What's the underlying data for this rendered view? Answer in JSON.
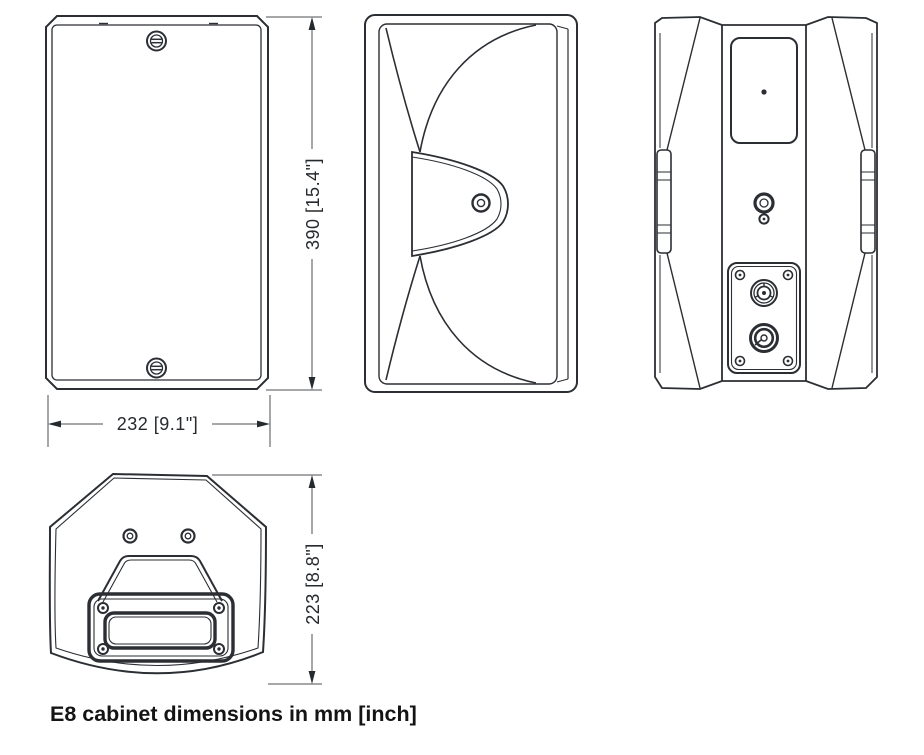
{
  "caption": {
    "text": "E8 cabinet dimensions in mm [inch]"
  },
  "views": {
    "front": {
      "height_dimension": "390 [15.4\"]",
      "width_dimension": "232 [9.1\"]"
    },
    "side": {},
    "rear": {},
    "top": {
      "depth_dimension": "223 [8.8\"]"
    }
  },
  "dimensions": {
    "product": "E8",
    "units": "mm [inch]",
    "height_mm": 390,
    "height_inch": 15.4,
    "width_mm": 232,
    "width_inch": 9.1,
    "depth_mm": 223,
    "depth_inch": 8.8
  },
  "colors": {
    "background": "#ffffff",
    "line": "#2b2e33",
    "dimension_line": "#4c4f53",
    "text": "#141414"
  }
}
